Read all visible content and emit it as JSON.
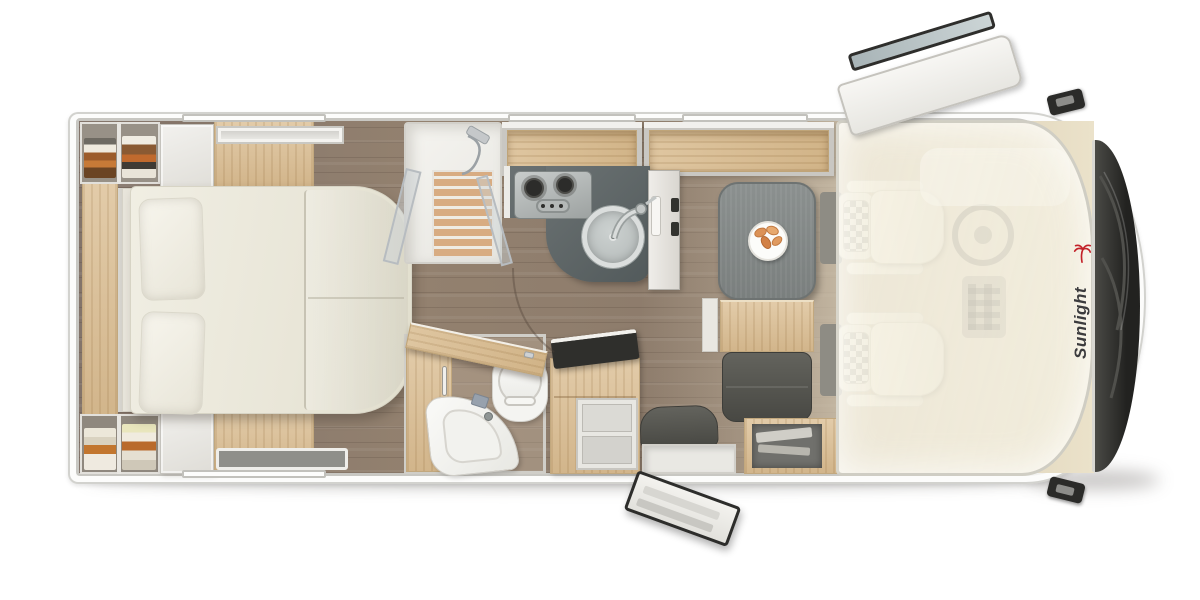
{
  "brand": {
    "name": "Sunlight",
    "text_color": "#3c3c3e",
    "palm_color": "#c3222a"
  },
  "scene": {
    "description": "Motorhome floor plan, top-down render, vehicle front at right",
    "rooms": [
      "rear bedroom with island bed",
      "shower cabin",
      "washroom with toilet and corner basin",
      "kitchen block",
      "dinette with table",
      "driver cab with swivel seats"
    ]
  },
  "counts": {
    "cab_seats": 2,
    "hob_burners": 2,
    "pillows": 2,
    "wall_windows": 4,
    "roof_skylights": 1,
    "open_doors": 3
  },
  "colors": {
    "page_bg": "#ffffff",
    "body_white": "#fbfbf9",
    "wall_gray": "#c8c7c2",
    "floor_wood": "#8b7b6e",
    "oak_light": "#dcc096",
    "counter_dark": "#5d6465",
    "table_gray": "#858a89",
    "cushion_gray": "#53534e",
    "seat_cream": "#efe9d8",
    "windshield_dark": "#2b2b29",
    "stainless": "#b6baba",
    "ceramic_white": "#f4f4f1"
  }
}
